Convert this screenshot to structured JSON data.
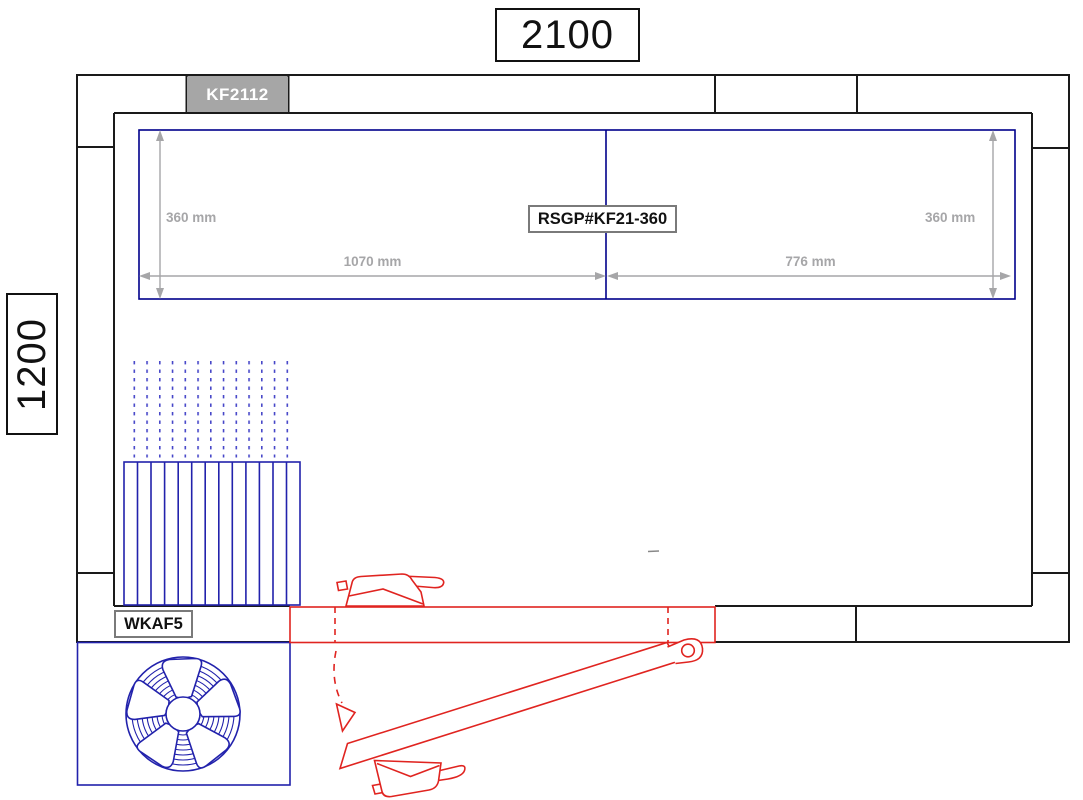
{
  "drawing": {
    "overall_width": "2100",
    "overall_height": "1200",
    "ceiling_unit_label": "KF2112",
    "rear_panel_label": "RSGP#KF21-360",
    "left_unit_label": "WKAF5",
    "dimensions": {
      "left_height": "360 mm",
      "right_height": "360 mm",
      "left_span": "1070 mm",
      "right_span": "776 mm"
    },
    "colors": {
      "wall_line": "#1a1a1a",
      "panel_blue": "#00008b",
      "equipment_blue": "#2222ac",
      "airflow_dot": "#4646c8",
      "door_red": "#e02420",
      "dimension_gray": "#a6a6a8",
      "unit_badge_fill": "#a6a6a6",
      "unit_badge_text": "#ffffff",
      "label_border": "#7a7a7a"
    }
  }
}
